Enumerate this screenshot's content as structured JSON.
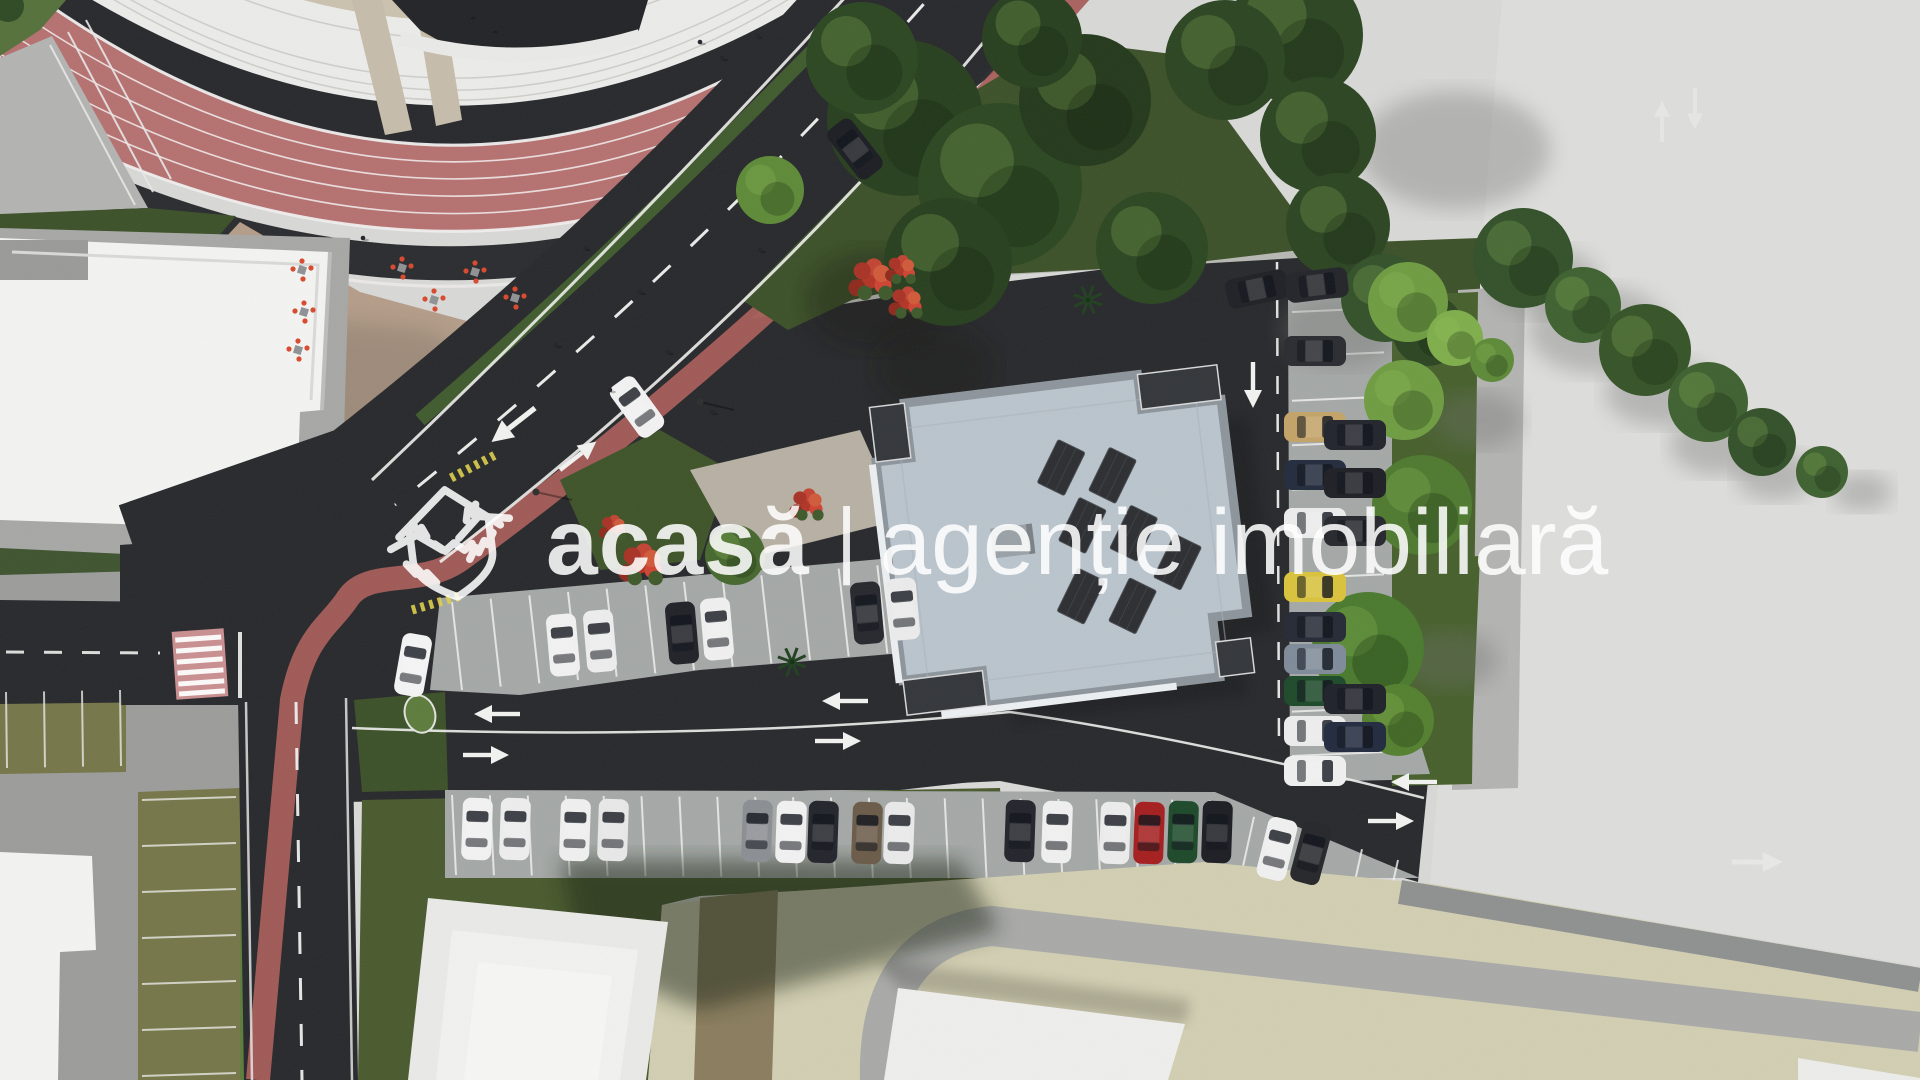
{
  "watermark": {
    "brand": "acasă",
    "separator": "|",
    "tagline": "agenție imobiliară",
    "logo_icon": "house-handshake-icon"
  },
  "colors": {
    "concrete": "#d8d8d6",
    "concrete_bright": "#e0dfdd",
    "asphalt": "#28292c",
    "asphalt_dark": "#202124",
    "track": "#b57170",
    "track_edge": "#2b2c2f",
    "bleachers": "#ebebe9",
    "concourse": "#cbc1ae",
    "plaza": "#b49d89",
    "lawn_dark": "#3c5129",
    "lawn_olive": "#76764a",
    "lawn_bright": "#5d7c3c",
    "bike_lane": "#a65d58",
    "crosswalk_pink": "#c98f90",
    "building_white": "#f3f3f1",
    "roof_blue_gray": "#bac4cc",
    "roof_parapet": "#8d959c",
    "terrace_dark": "#33363a",
    "solar_panel": "#2c2e31",
    "pavers": "#a4a8a6",
    "pavers_light": "#b3b3b1",
    "beige_ground": "#d2ceb2",
    "gray_band": "#a9aaa8",
    "path_brown": "#8a7d5e",
    "marking_white": "#f2f2f0",
    "marking_yellow": "#ddd04a",
    "chair_red": "#d8492e",
    "tree_dark": "#2c4522",
    "tree_light": "#6f9c42",
    "shadow": "#6e6f6d"
  },
  "scene": {
    "type": "aerial-architectural-render",
    "elements": [
      "stadium-running-track",
      "stadium-bleachers",
      "event-plaza-cafe-seating",
      "white-building-west",
      "residential-building-center",
      "rooftop-solar-panels",
      "curved-boulevard",
      "red-bike-lane",
      "pedestrian-crosswalk",
      "street-parking-rows",
      "grass-paver-parking",
      "lawns-and-trees",
      "concrete-esplanade-east",
      "white-building-southwest",
      "building-southeast"
    ]
  },
  "parking": {
    "south_row": {
      "default_rot": 2,
      "cars": [
        {
          "x": 462,
          "y": 798,
          "c": "#f2f2f2"
        },
        {
          "x": 500,
          "y": 798,
          "c": "#ededed"
        },
        {
          "x": 560,
          "y": 799,
          "c": "#f0f0f0"
        },
        {
          "x": 598,
          "y": 799,
          "c": "#e8e8e8"
        },
        {
          "x": 742,
          "y": 800,
          "c": "#8b8f93"
        },
        {
          "x": 776,
          "y": 801,
          "c": "#f1f1f1"
        },
        {
          "x": 808,
          "y": 801,
          "c": "#23252c"
        },
        {
          "x": 852,
          "y": 802,
          "c": "#6b5b49"
        },
        {
          "x": 884,
          "y": 802,
          "c": "#e9e9e9"
        },
        {
          "x": 1005,
          "y": 800,
          "c": "#23252c"
        },
        {
          "x": 1042,
          "y": 801,
          "c": "#f0f0f0"
        },
        {
          "x": 1100,
          "y": 802,
          "c": "#ececec"
        },
        {
          "x": 1134,
          "y": 802,
          "c": "#a61f1f"
        },
        {
          "x": 1168,
          "y": 801,
          "c": "#1d4a2a"
        },
        {
          "x": 1202,
          "y": 801,
          "c": "#1c1e24"
        },
        {
          "x": 1262,
          "y": 818,
          "rot": 14,
          "c": "#f0f0f0"
        },
        {
          "x": 1296,
          "y": 822,
          "rot": 15,
          "c": "#26272b"
        }
      ]
    },
    "north_row": {
      "default_rot": -5,
      "cars": [
        {
          "x": 548,
          "y": 614,
          "c": "#f1f1f1"
        },
        {
          "x": 585,
          "y": 610,
          "c": "#ededed"
        },
        {
          "x": 667,
          "y": 602,
          "c": "#202228"
        },
        {
          "x": 702,
          "y": 598,
          "c": "#f0f0f0"
        },
        {
          "x": 852,
          "y": 582,
          "c": "#26282e"
        },
        {
          "x": 888,
          "y": 578,
          "c": "#ebebeb"
        }
      ]
    },
    "east_column": {
      "x": 1300,
      "default_rot": 90,
      "cars": [
        {
          "y": 320,
          "c": "#2a2c31"
        },
        {
          "y": 396,
          "c": "#c3a368"
        },
        {
          "y": 444,
          "c": "#232c3d"
        },
        {
          "y": 492,
          "c": "#ececec"
        },
        {
          "y": 556,
          "c": "#d9c23c"
        },
        {
          "y": 596,
          "c": "#252a36"
        },
        {
          "y": 628,
          "c": "#7f8b99"
        },
        {
          "y": 660,
          "c": "#1d4a2a"
        },
        {
          "y": 700,
          "c": "#ececec"
        },
        {
          "y": 740,
          "c": "#f0f0f0"
        }
      ]
    },
    "east_column_2": {
      "x": 1340,
      "default_rot": 90,
      "cars": [
        {
          "y": 404,
          "c": "#23252d"
        },
        {
          "y": 452,
          "c": "#1e2026"
        },
        {
          "y": 500,
          "c": "#26282e"
        },
        {
          "y": 668,
          "c": "#20222a"
        },
        {
          "y": 706,
          "c": "#222b3f"
        }
      ]
    },
    "road_cars": [
      {
        "x": 398,
        "y": 634,
        "rot": 10,
        "c": "#f4f4f4"
      },
      {
        "x": 840,
        "y": 118,
        "rot": -38,
        "c": "#1c1e24"
      },
      {
        "x": 622,
        "y": 376,
        "rot": -36,
        "c": "#f2f2f2"
      },
      {
        "x": 1242,
        "y": 258,
        "rot": 78,
        "c": "#1f2126"
      },
      {
        "x": 1302,
        "y": 254,
        "rot": 83,
        "c": "#23252a"
      }
    ],
    "stall_lines": [
      {
        "x0": 452,
        "y0": 795,
        "x1": 1210,
        "y1": 800,
        "n": 21,
        "pdx": 4,
        "pdy": 80
      },
      {
        "x0": 1218,
        "y0": 806,
        "x1": 1398,
        "y1": 860,
        "n": 6,
        "pdx": -16,
        "pdy": 72
      },
      {
        "x0": 452,
        "y0": 602,
        "x1": 1032,
        "y1": 552,
        "n": 16,
        "pdx": 10,
        "pdy": 88
      },
      {
        "x0": 1292,
        "y0": 312,
        "x1": 1292,
        "y1": 756,
        "n": 11,
        "pdx": 92,
        "pdy": -4
      },
      {
        "x0": 142,
        "y0": 800,
        "x1": 142,
        "y1": 1076,
        "n": 7,
        "pdx": 94,
        "pdy": -3,
        "c": "#e8e8e4"
      },
      {
        "x0": 6,
        "y0": 692,
        "x1": 120,
        "y1": 690,
        "n": 4,
        "pdx": 1,
        "pdy": 76,
        "c": "#e8e8e4"
      }
    ]
  },
  "vegetation": {
    "trees": [
      {
        "x": 1295,
        "y": 35,
        "r": 68,
        "c": "#2c4522"
      },
      {
        "x": 1318,
        "y": 135,
        "r": 58,
        "c": "#2c4522"
      },
      {
        "x": 1338,
        "y": 225,
        "r": 52,
        "c": "#2c4522"
      },
      {
        "x": 1385,
        "y": 298,
        "r": 44,
        "c": "#33512a"
      },
      {
        "x": 1428,
        "y": 330,
        "r": 36,
        "c": "#2c4522"
      },
      {
        "x": 1523,
        "y": 258,
        "r": 50,
        "c": "#33512a"
      },
      {
        "x": 1583,
        "y": 305,
        "r": 38,
        "c": "#3f6130"
      },
      {
        "x": 1645,
        "y": 350,
        "r": 46,
        "c": "#365428"
      },
      {
        "x": 1708,
        "y": 402,
        "r": 40,
        "c": "#3f6130"
      },
      {
        "x": 1762,
        "y": 442,
        "r": 34,
        "c": "#33512a"
      },
      {
        "x": 1822,
        "y": 472,
        "r": 26,
        "c": "#3f6130"
      },
      {
        "x": 1408,
        "y": 302,
        "r": 40,
        "c": "#6f9c42"
      },
      {
        "x": 1455,
        "y": 338,
        "r": 28,
        "c": "#7fae4b"
      },
      {
        "x": 1492,
        "y": 360,
        "r": 22,
        "c": "#5d8a38"
      },
      {
        "x": 905,
        "y": 118,
        "r": 78,
        "c": "#28401f"
      },
      {
        "x": 1000,
        "y": 185,
        "r": 82,
        "c": "#2c4722"
      },
      {
        "x": 1085,
        "y": 100,
        "r": 66,
        "c": "#24391c"
      },
      {
        "x": 1152,
        "y": 248,
        "r": 56,
        "c": "#2c4722"
      },
      {
        "x": 948,
        "y": 262,
        "r": 64,
        "c": "#28401f"
      },
      {
        "x": 862,
        "y": 58,
        "r": 56,
        "c": "#2c4722"
      },
      {
        "x": 1032,
        "y": 38,
        "r": 50,
        "c": "#28401f"
      },
      {
        "x": 1225,
        "y": 60,
        "r": 60,
        "c": "#2c4522"
      },
      {
        "x": 770,
        "y": 190,
        "r": 34,
        "c": "#5e8a38"
      },
      {
        "x": 1404,
        "y": 400,
        "r": 40,
        "c": "#6f9c42"
      },
      {
        "x": 1422,
        "y": 505,
        "r": 50,
        "c": "#4f7a30"
      },
      {
        "x": 1368,
        "y": 648,
        "r": 56,
        "c": "#4a7a2e"
      },
      {
        "x": 1398,
        "y": 720,
        "r": 36,
        "c": "#54802f"
      },
      {
        "x": 735,
        "y": 555,
        "r": 30,
        "c": "#46682e"
      }
    ],
    "tree_shadows": [
      {
        "x": 1455,
        "y": 150,
        "r": 95
      },
      {
        "x": 1340,
        "y": 330,
        "r": 60
      },
      {
        "x": 1545,
        "y": 282,
        "r": 55
      },
      {
        "x": 1598,
        "y": 330,
        "r": 70
      },
      {
        "x": 1660,
        "y": 392,
        "r": 55
      },
      {
        "x": 1718,
        "y": 445,
        "r": 48
      },
      {
        "x": 1775,
        "y": 475,
        "r": 40
      },
      {
        "x": 1862,
        "y": 492,
        "r": 30
      },
      {
        "x": 1478,
        "y": 420,
        "r": 45
      },
      {
        "x": 1450,
        "y": 660,
        "r": 48
      }
    ],
    "red_bushes": [
      {
        "x": 870,
        "y": 280,
        "r": 26
      },
      {
        "x": 905,
        "y": 303,
        "r": 20
      },
      {
        "x": 806,
        "y": 505,
        "r": 20
      },
      {
        "x": 640,
        "y": 565,
        "r": 26
      },
      {
        "x": 612,
        "y": 528,
        "r": 16
      },
      {
        "x": 900,
        "y": 270,
        "r": 18
      }
    ],
    "palms": [
      {
        "x": 792,
        "y": 662
      },
      {
        "x": 1088,
        "y": 300
      }
    ]
  },
  "plaza": {
    "chair_clusters": [
      [
        302,
        270
      ],
      [
        304,
        312
      ],
      [
        298,
        350
      ],
      [
        402,
        268
      ],
      [
        434,
        300
      ],
      [
        475,
        272
      ],
      [
        515,
        298
      ]
    ],
    "people": [
      [
        585,
        248
      ],
      [
        640,
        292
      ],
      [
        668,
        352
      ],
      [
        712,
        412
      ],
      [
        556,
        345
      ],
      [
        610,
        390
      ],
      [
        363,
        238
      ],
      [
        760,
        250
      ]
    ]
  },
  "stadium": {
    "concourse_people": [
      [
        470,
        16
      ],
      [
        492,
        30
      ],
      [
        700,
        42
      ],
      [
        722,
        58
      ],
      [
        758,
        36
      ],
      [
        820,
        24
      ],
      [
        846,
        48
      ],
      [
        906,
        34
      ]
    ],
    "track_people": [
      [
        570,
        300
      ],
      [
        588,
        318
      ],
      [
        604,
        334
      ],
      [
        772,
        182
      ],
      [
        940,
        58
      ],
      [
        952,
        74
      ]
    ]
  }
}
